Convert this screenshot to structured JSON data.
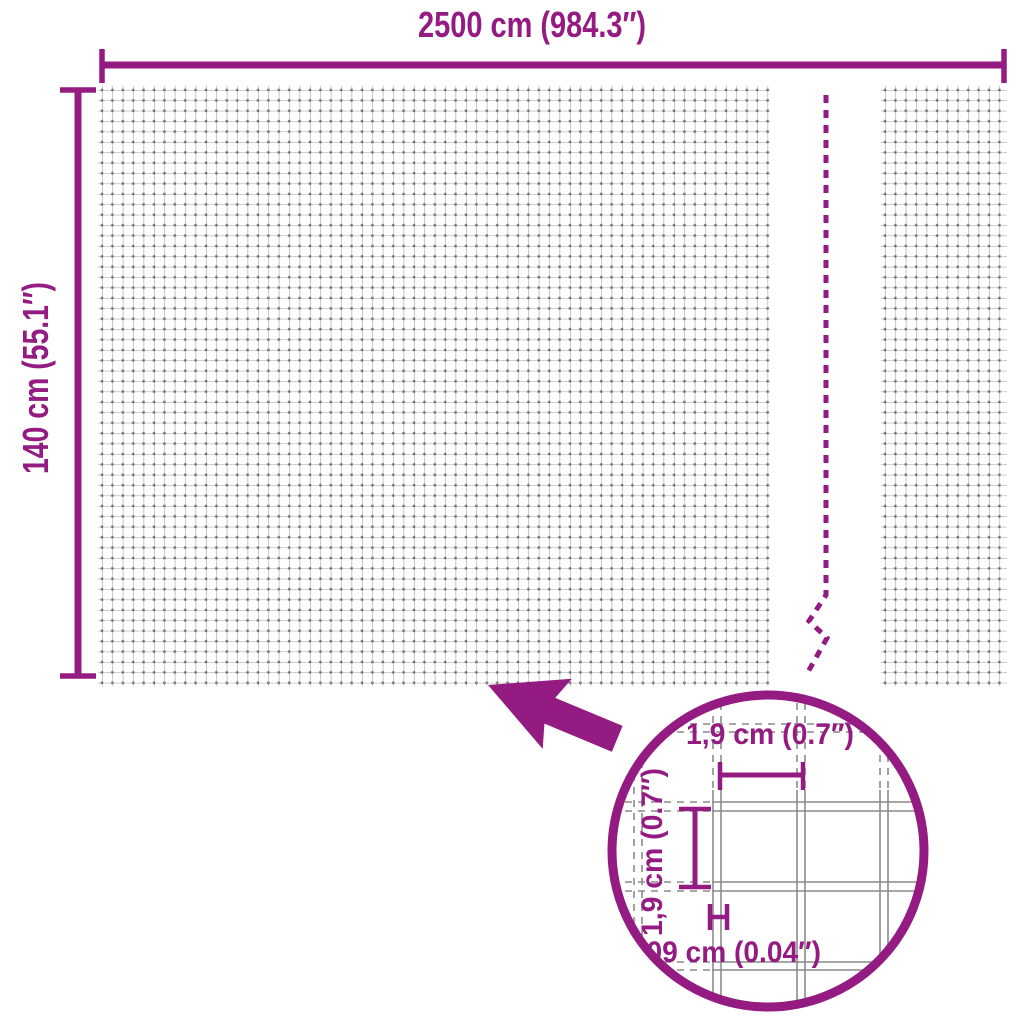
{
  "diagram": {
    "overall": {
      "width_label": "2500 cm (984.3″)",
      "height_label": "140 cm (55.1″)"
    },
    "detail_lens": {
      "mesh_opening_width_label": "1,9 cm (0.7″)",
      "mesh_opening_height_label": "1,9 cm (0.7″)",
      "wire_thickness_label": "0,09 cm (0.04″)"
    },
    "colors": {
      "accent": "#931B82",
      "mesh_grid_line": "#9A9A9A",
      "mesh_grid_node": "#6F6F6F",
      "lens_wire_gray": "#8A8A8A",
      "background": "#FFFFFF"
    }
  }
}
